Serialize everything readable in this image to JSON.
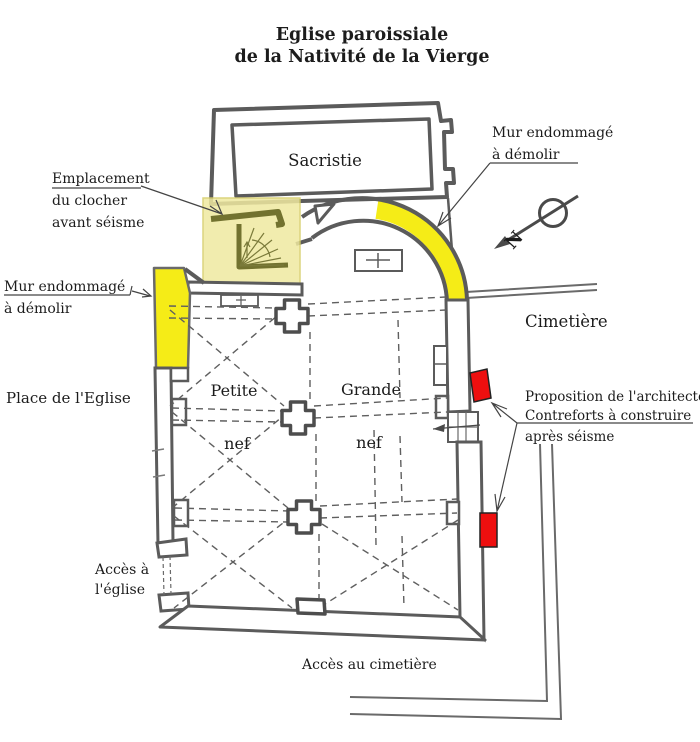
{
  "title": {
    "line1": "Eglise paroissiale",
    "line2": "de la Nativité de la Vierge"
  },
  "plan_labels": {
    "sacristy": "Sacristie",
    "small_nave_word1": "Petite",
    "small_nave_word2": "nef",
    "large_nave_word1": "Grande",
    "large_nave_word2": "nef"
  },
  "surroundings": {
    "cemetery": "Cimetière",
    "church_square": "Place de l'Eglise",
    "church_access_line1": "Accès à",
    "church_access_line2": "l'église",
    "cemetery_access": "Accès au cimetière"
  },
  "annotations": {
    "bell_tower_location": {
      "line1": "Emplacement",
      "line2": "du clocher",
      "line3": "avant séisme"
    },
    "damaged_wall_right": {
      "line1": "Mur endommagé",
      "line2": "à démolir"
    },
    "damaged_wall_left": {
      "line1": "Mur endommagé",
      "line2": "à démolir"
    },
    "architect_proposal": {
      "line1": "Proposition de l'architecte",
      "line2": "Contreforts à construire",
      "line3": "après séisme"
    }
  },
  "north_arrow": {
    "letter": "N"
  },
  "colors": {
    "damaged_highlight": "#f5ec17",
    "bell_tower_highlight": "#efe9a0",
    "buttress_red": "#ee0f0f",
    "wall_gray": "#5b5b5b"
  }
}
